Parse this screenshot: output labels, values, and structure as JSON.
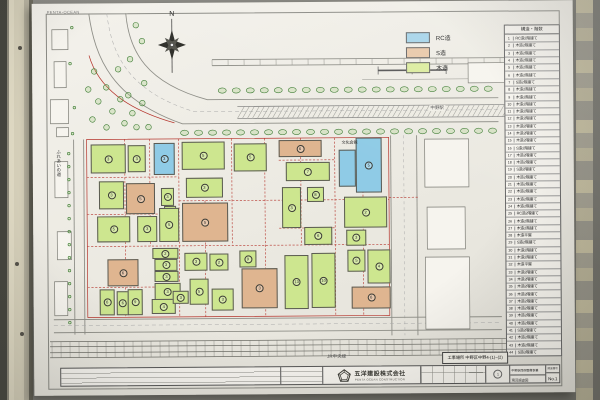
{
  "corner_text": "PENTA-OCEAN",
  "legend": {
    "items": [
      {
        "label": "RC造",
        "color": "#a6d4e9"
      },
      {
        "label": "S造",
        "color": "#e9c8a9"
      },
      {
        "label": "木造",
        "color": "#dcec9f"
      }
    ]
  },
  "table": {
    "header": "構造・階数",
    "rows": [
      {
        "no": "1",
        "label": "RC造2階建て"
      },
      {
        "no": "2",
        "label": "木造2階建て"
      },
      {
        "no": "3",
        "label": "木造2階建て"
      },
      {
        "no": "4",
        "label": "木造2階建て"
      },
      {
        "no": "5",
        "label": "木造2階建て"
      },
      {
        "no": "6",
        "label": "木造2階建て"
      },
      {
        "no": "7",
        "label": "S造2階建て"
      },
      {
        "no": "8",
        "label": "木造2階建て"
      },
      {
        "no": "9",
        "label": "木造2階建て"
      },
      {
        "no": "10",
        "label": "木造2階建て"
      },
      {
        "no": "11",
        "label": "木造2階建て"
      },
      {
        "no": "12",
        "label": "木造2階建て"
      },
      {
        "no": "13",
        "label": "木造2階建て"
      },
      {
        "no": "14",
        "label": "木造2階建て"
      },
      {
        "no": "15",
        "label": "木造2階建て"
      },
      {
        "no": "16",
        "label": "S造2階建て"
      },
      {
        "no": "17",
        "label": "木造2階建て"
      },
      {
        "no": "18",
        "label": "木造2階建て"
      },
      {
        "no": "19",
        "label": "S造2階建て"
      },
      {
        "no": "20",
        "label": "木造2階建て"
      },
      {
        "no": "21",
        "label": "木造2階建て"
      },
      {
        "no": "22",
        "label": "木造2階建て"
      },
      {
        "no": "23",
        "label": "木造2階建て"
      },
      {
        "no": "24",
        "label": "木造2階建て"
      },
      {
        "no": "25",
        "label": "RC造2階建て"
      },
      {
        "no": "26",
        "label": "木造2階建て"
      },
      {
        "no": "27",
        "label": "木造2階建て"
      },
      {
        "no": "28",
        "label": "木造平屋"
      },
      {
        "no": "29",
        "label": "S造2階建て"
      },
      {
        "no": "30",
        "label": "木造2階建て"
      },
      {
        "no": "31",
        "label": "木造2階建て"
      },
      {
        "no": "32",
        "label": "木造平屋"
      },
      {
        "no": "33",
        "label": "木造2階建て"
      },
      {
        "no": "34",
        "label": "木造2階建て"
      },
      {
        "no": "35",
        "label": "木造2階建て"
      },
      {
        "no": "36",
        "label": "木造2階建て"
      },
      {
        "no": "37",
        "label": "木造2階建て"
      },
      {
        "no": "38",
        "label": "木造2階建て"
      },
      {
        "no": "39",
        "label": "木造2階建て"
      },
      {
        "no": "40",
        "label": "木造2階建て"
      },
      {
        "no": "41",
        "label": "S造2階建て"
      },
      {
        "no": "42",
        "label": "木造2階建て"
      },
      {
        "no": "43",
        "label": "木造2階建て"
      },
      {
        "no": "44",
        "label": "S造3階建て"
      }
    ]
  },
  "map": {
    "colors": {
      "rc": "#8fcbe6",
      "s": "#dfb590",
      "wood": "#cde68f"
    },
    "labels": {
      "north": "N",
      "street_left": "ふれあいの道",
      "station": "中野駅",
      "hall": "文化会館",
      "rail_line": "JR中央線"
    },
    "parcels": [
      {
        "x": 58,
        "y": 141,
        "w": 35,
        "h": 29,
        "t": "wood",
        "n": "3"
      },
      {
        "x": 95,
        "y": 142,
        "w": 18,
        "h": 27,
        "t": "wood",
        "n": "3"
      },
      {
        "x": 121,
        "y": 140,
        "w": 21,
        "h": 32,
        "t": "rc",
        "n": "3"
      },
      {
        "x": 149,
        "y": 139,
        "w": 43,
        "h": 28,
        "t": "wood",
        "n": "5"
      },
      {
        "x": 201,
        "y": 141,
        "w": 33,
        "h": 28,
        "t": "wood",
        "n": "5"
      },
      {
        "x": 246,
        "y": 138,
        "w": 43,
        "h": 17,
        "t": "s",
        "n": "6"
      },
      {
        "x": 253,
        "y": 160,
        "w": 44,
        "h": 19,
        "t": "wood",
        "n": "7"
      },
      {
        "x": 306,
        "y": 148,
        "w": 17,
        "h": 37,
        "t": "rc"
      },
      {
        "x": 323,
        "y": 136,
        "w": 26,
        "h": 55,
        "t": "rc",
        "n": "5"
      },
      {
        "x": 66,
        "y": 178,
        "w": 25,
        "h": 28,
        "t": "wood",
        "n": "3"
      },
      {
        "x": 93,
        "y": 180,
        "w": 29,
        "h": 31,
        "t": "s",
        "n": "5"
      },
      {
        "x": 128,
        "y": 185,
        "w": 13,
        "h": 18,
        "t": "wood",
        "n": "3"
      },
      {
        "x": 131,
        "y": 203,
        "w": 12,
        "h": 12,
        "t": "wood"
      },
      {
        "x": 153,
        "y": 175,
        "w": 37,
        "h": 20,
        "t": "wood",
        "n": "3"
      },
      {
        "x": 249,
        "y": 185,
        "w": 19,
        "h": 41,
        "t": "wood",
        "n": "3"
      },
      {
        "x": 274,
        "y": 185,
        "w": 17,
        "h": 15,
        "t": "wood",
        "n": "8"
      },
      {
        "x": 311,
        "y": 195,
        "w": 43,
        "h": 31,
        "t": "wood",
        "n": "2"
      },
      {
        "x": 64,
        "y": 213,
        "w": 33,
        "h": 26,
        "t": "wood",
        "n": "5"
      },
      {
        "x": 104,
        "y": 213,
        "w": 20,
        "h": 26,
        "t": "wood",
        "n": "3"
      },
      {
        "x": 126,
        "y": 205,
        "w": 20,
        "h": 34,
        "t": "wood",
        "n": "5"
      },
      {
        "x": 149,
        "y": 200,
        "w": 46,
        "h": 39,
        "t": "s",
        "n": "5"
      },
      {
        "x": 271,
        "y": 225,
        "w": 28,
        "h": 18,
        "t": "wood",
        "n": "6"
      },
      {
        "x": 313,
        "y": 228,
        "w": 20,
        "h": 16,
        "t": "wood",
        "n": "3"
      },
      {
        "x": 74,
        "y": 256,
        "w": 31,
        "h": 27,
        "t": "s",
        "n": "6"
      },
      {
        "x": 66,
        "y": 286,
        "w": 15,
        "h": 26,
        "t": "wood",
        "n": "6"
      },
      {
        "x": 83,
        "y": 288,
        "w": 12,
        "h": 24,
        "t": "wood",
        "n": "6"
      },
      {
        "x": 94,
        "y": 286,
        "w": 15,
        "h": 26,
        "t": "wood",
        "n": "9"
      },
      {
        "x": 119,
        "y": 245,
        "w": 26,
        "h": 11,
        "t": "wood",
        "n": "2"
      },
      {
        "x": 121,
        "y": 256,
        "w": 23,
        "h": 12,
        "t": "wood",
        "n": "3"
      },
      {
        "x": 121,
        "y": 268,
        "w": 24,
        "h": 11,
        "t": "wood",
        "n": "3"
      },
      {
        "x": 121,
        "y": 280,
        "w": 26,
        "h": 17,
        "t": "wood",
        "n": "3"
      },
      {
        "x": 118,
        "y": 296,
        "w": 24,
        "h": 15,
        "t": "wood",
        "n": "4"
      },
      {
        "x": 139,
        "y": 288,
        "w": 16,
        "h": 13,
        "t": "wood",
        "n": "3"
      },
      {
        "x": 151,
        "y": 250,
        "w": 23,
        "h": 18,
        "t": "wood",
        "n": "3"
      },
      {
        "x": 176,
        "y": 251,
        "w": 19,
        "h": 17,
        "t": "wood",
        "n": "2"
      },
      {
        "x": 156,
        "y": 276,
        "w": 19,
        "h": 26,
        "t": "wood",
        "n": "5"
      },
      {
        "x": 178,
        "y": 286,
        "w": 22,
        "h": 22,
        "t": "wood",
        "n": "3"
      },
      {
        "x": 206,
        "y": 248,
        "w": 17,
        "h": 17,
        "t": "wood",
        "n": "9"
      },
      {
        "x": 208,
        "y": 266,
        "w": 36,
        "h": 40,
        "t": "s",
        "n": "3"
      },
      {
        "x": 251,
        "y": 253,
        "w": 24,
        "h": 54,
        "t": "wood",
        "n": "13"
      },
      {
        "x": 278,
        "y": 251,
        "w": 24,
        "h": 55,
        "t": "wood",
        "n": "10"
      },
      {
        "x": 314,
        "y": 248,
        "w": 18,
        "h": 22,
        "t": "wood",
        "n": "5"
      },
      {
        "x": 334,
        "y": 248,
        "w": 23,
        "h": 34,
        "t": "wood",
        "n": "4"
      },
      {
        "x": 318,
        "y": 285,
        "w": 39,
        "h": 22,
        "t": "s",
        "n": "6"
      }
    ]
  },
  "site_box": {
    "label": "工事場所 中野区中野4-(1)~(2)"
  },
  "titleblock": {
    "company": "五洋建設株式会社",
    "company_en": "PENTA OCEAN CONSTRUCTION",
    "project": "中野駅西側整備事業",
    "drawing": "現況調査図",
    "stamp": "1",
    "sheet_label": "図面番号",
    "sheet_no": "No.1"
  }
}
